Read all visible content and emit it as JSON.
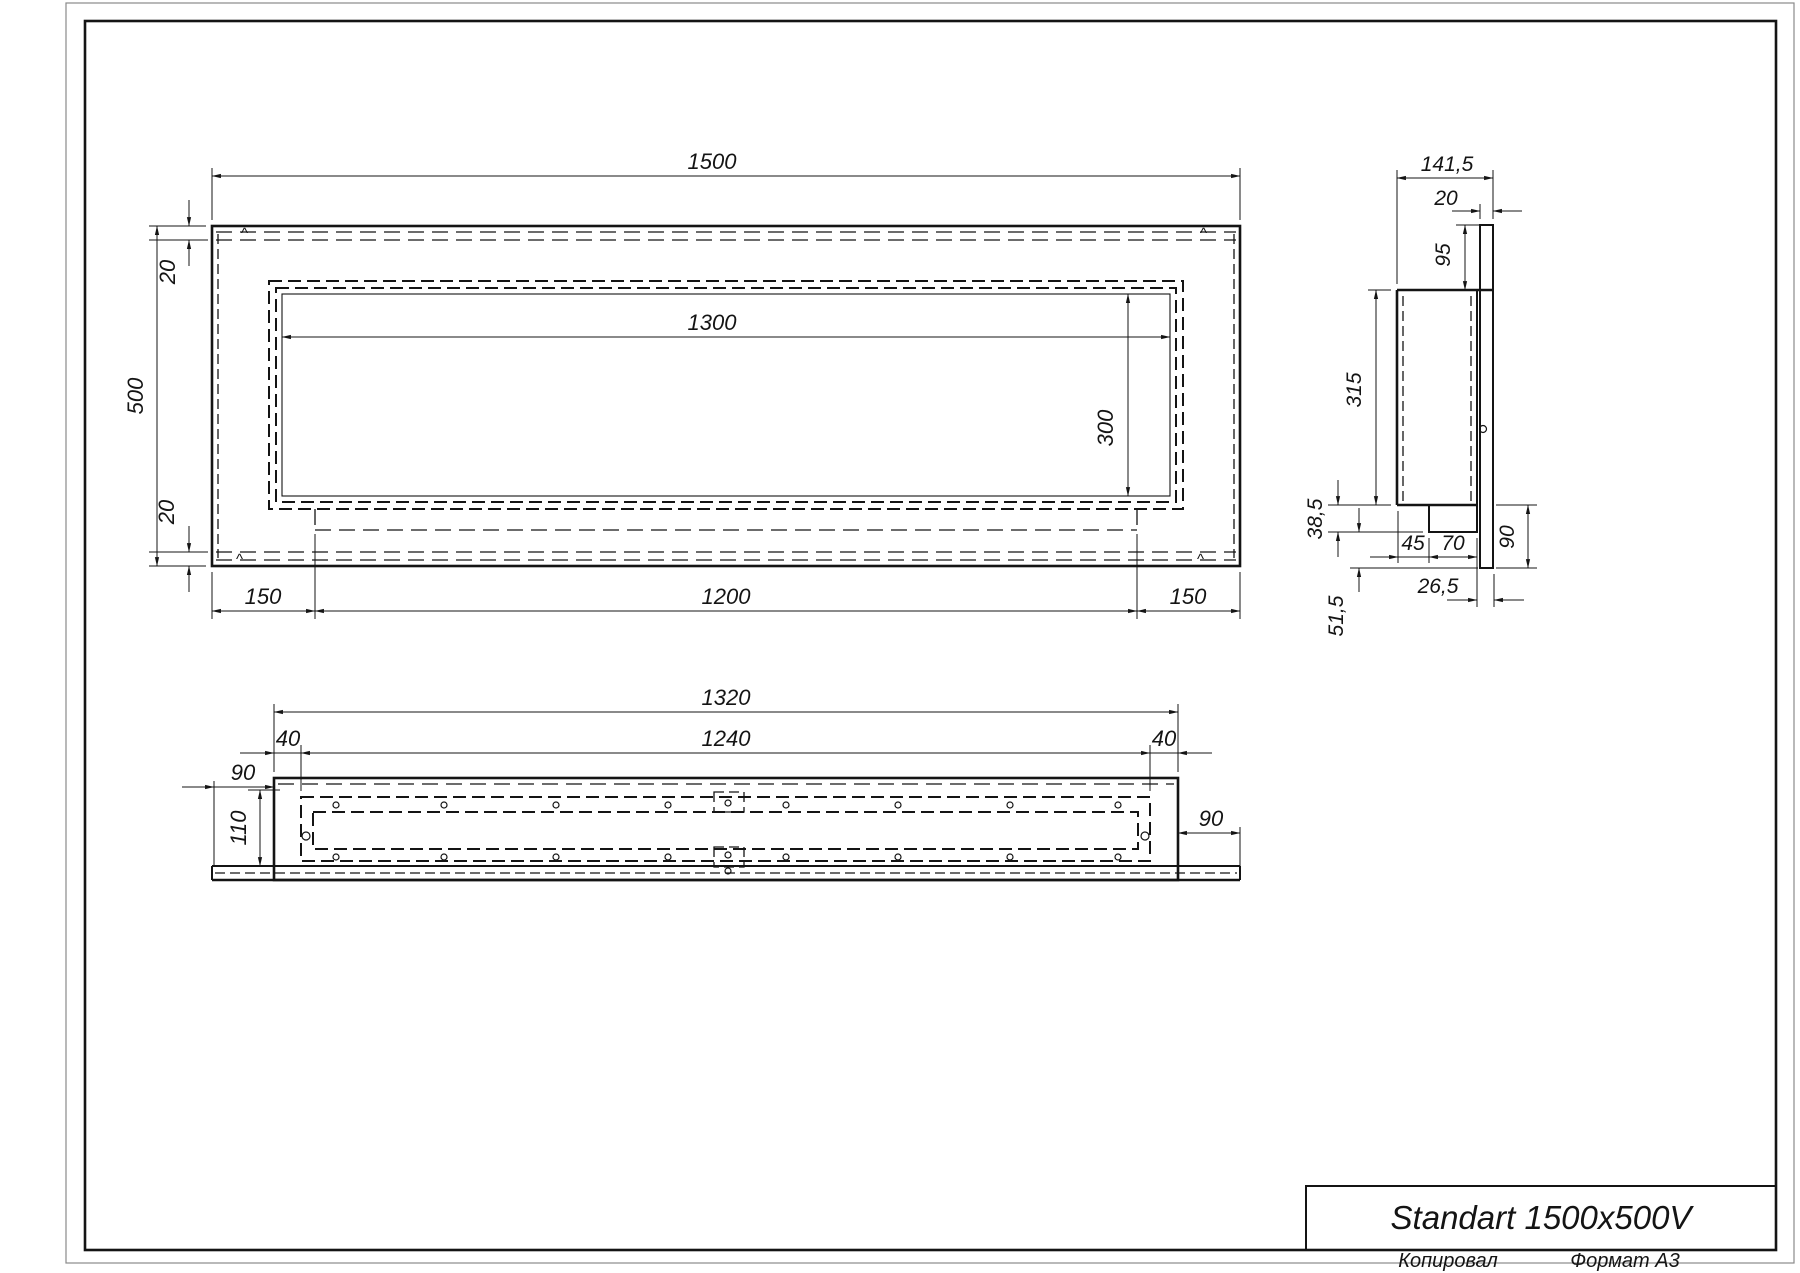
{
  "page": {
    "format_note": "A3 drawing sheet",
    "marks": {
      "corner": "^"
    },
    "title_block": {
      "title": "Standart 1500x500V"
    },
    "footer": {
      "copied_label": "Копировал",
      "format_label": "Формат А3"
    }
  },
  "views": {
    "front": {
      "name": "front-view",
      "dims": {
        "overall_width": "1500",
        "overall_height": "500",
        "top_offset": "20",
        "bottom_offset": "20",
        "opening_width": "1300",
        "opening_height": "300",
        "left_margin": "150",
        "burner_length": "1200",
        "right_margin": "150"
      }
    },
    "side": {
      "name": "side-view",
      "dims": {
        "depth": "141,5",
        "flange_thickness": "20",
        "flange_height": "95",
        "body_height": "315",
        "tray_height": "38,5",
        "tray_offset": "45",
        "tray_width": "70",
        "back_drop": "90",
        "back_gap": "26,5",
        "lower_drop": "51,5"
      }
    },
    "bottom": {
      "name": "bottom-view",
      "dims": {
        "outer_width": "1320",
        "inner_width": "1240",
        "left_inset": "40",
        "right_inset": "40",
        "left_flange": "90",
        "right_flange": "90",
        "inner_depth": "110"
      }
    }
  }
}
